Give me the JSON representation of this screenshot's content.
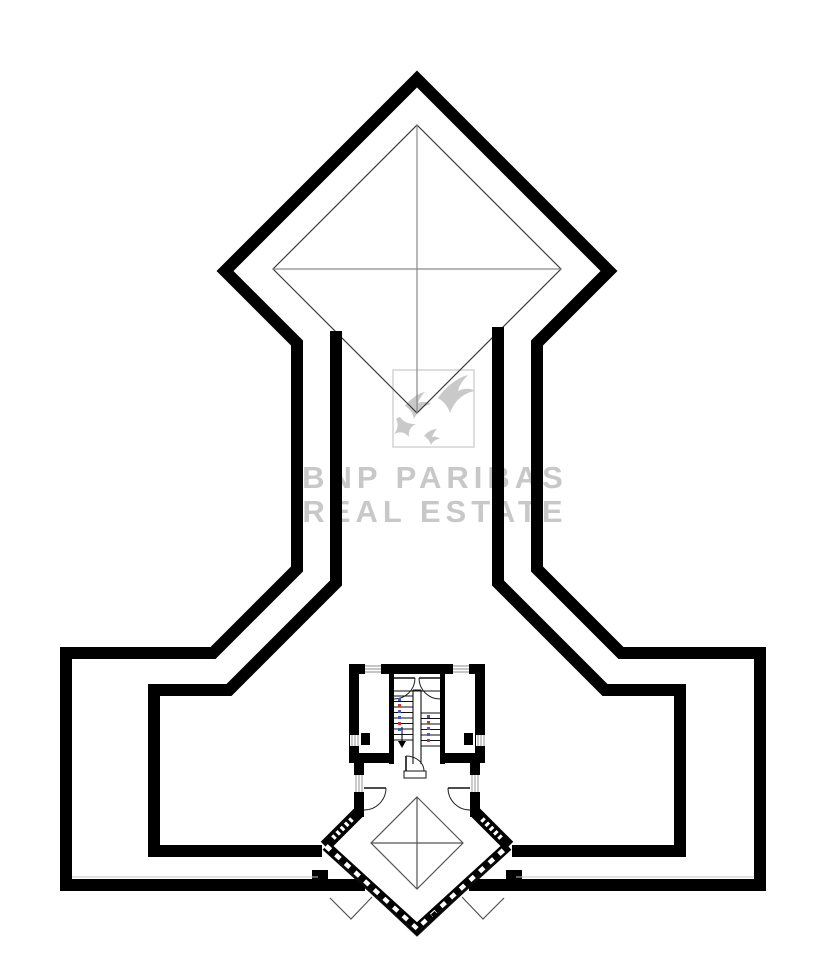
{
  "watermark": {
    "line1": "BNP PARIBAS",
    "line2": "REAL ESTATE",
    "color": "#c8c8c8",
    "logo_color": "#c9c9c9",
    "logo_icon": "bnp-paribas-birds-icon"
  },
  "plan": {
    "type": "architectural-floor-plan",
    "background": "#ffffff",
    "wall_color": "#000000",
    "thin_line_color": "#3c3c3c",
    "stair_mark_blue": "#4857c4",
    "stair_mark_red": "#c0392b"
  }
}
